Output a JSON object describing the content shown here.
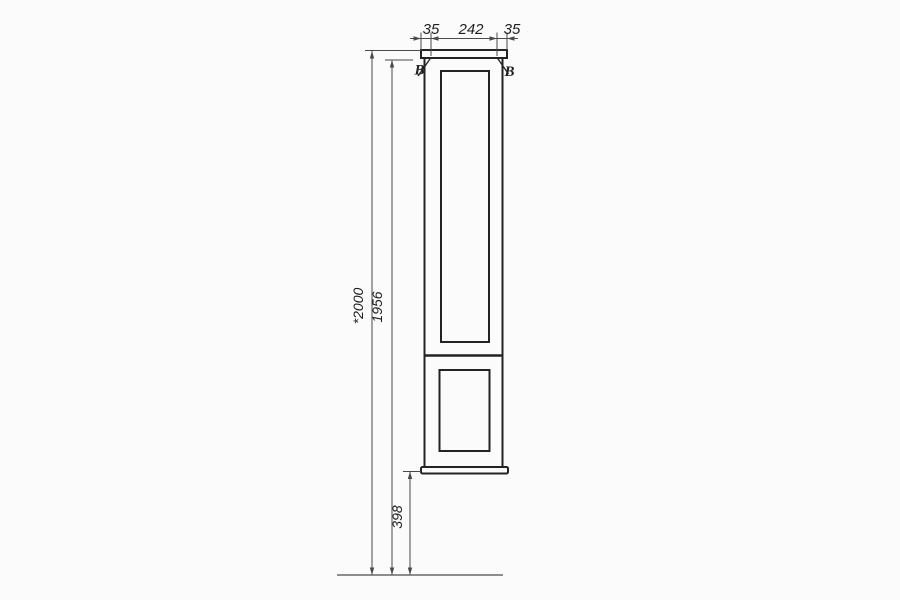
{
  "meta": {
    "background": "#fbfbfb",
    "object_line_color": "#232323",
    "dimension_line_color": "#4a4a4a",
    "floor_line_color": "#6a6a6a",
    "text_color": "#1f1f1f"
  },
  "drawing": {
    "type": "cabinet-front-elevation",
    "top_dims": {
      "left": "35",
      "middle": "242",
      "right": "35"
    },
    "height_dims": {
      "overall": "*2000",
      "carcass": "1956",
      "clearance": "398"
    },
    "section": {
      "left": "В",
      "right": "В"
    }
  }
}
